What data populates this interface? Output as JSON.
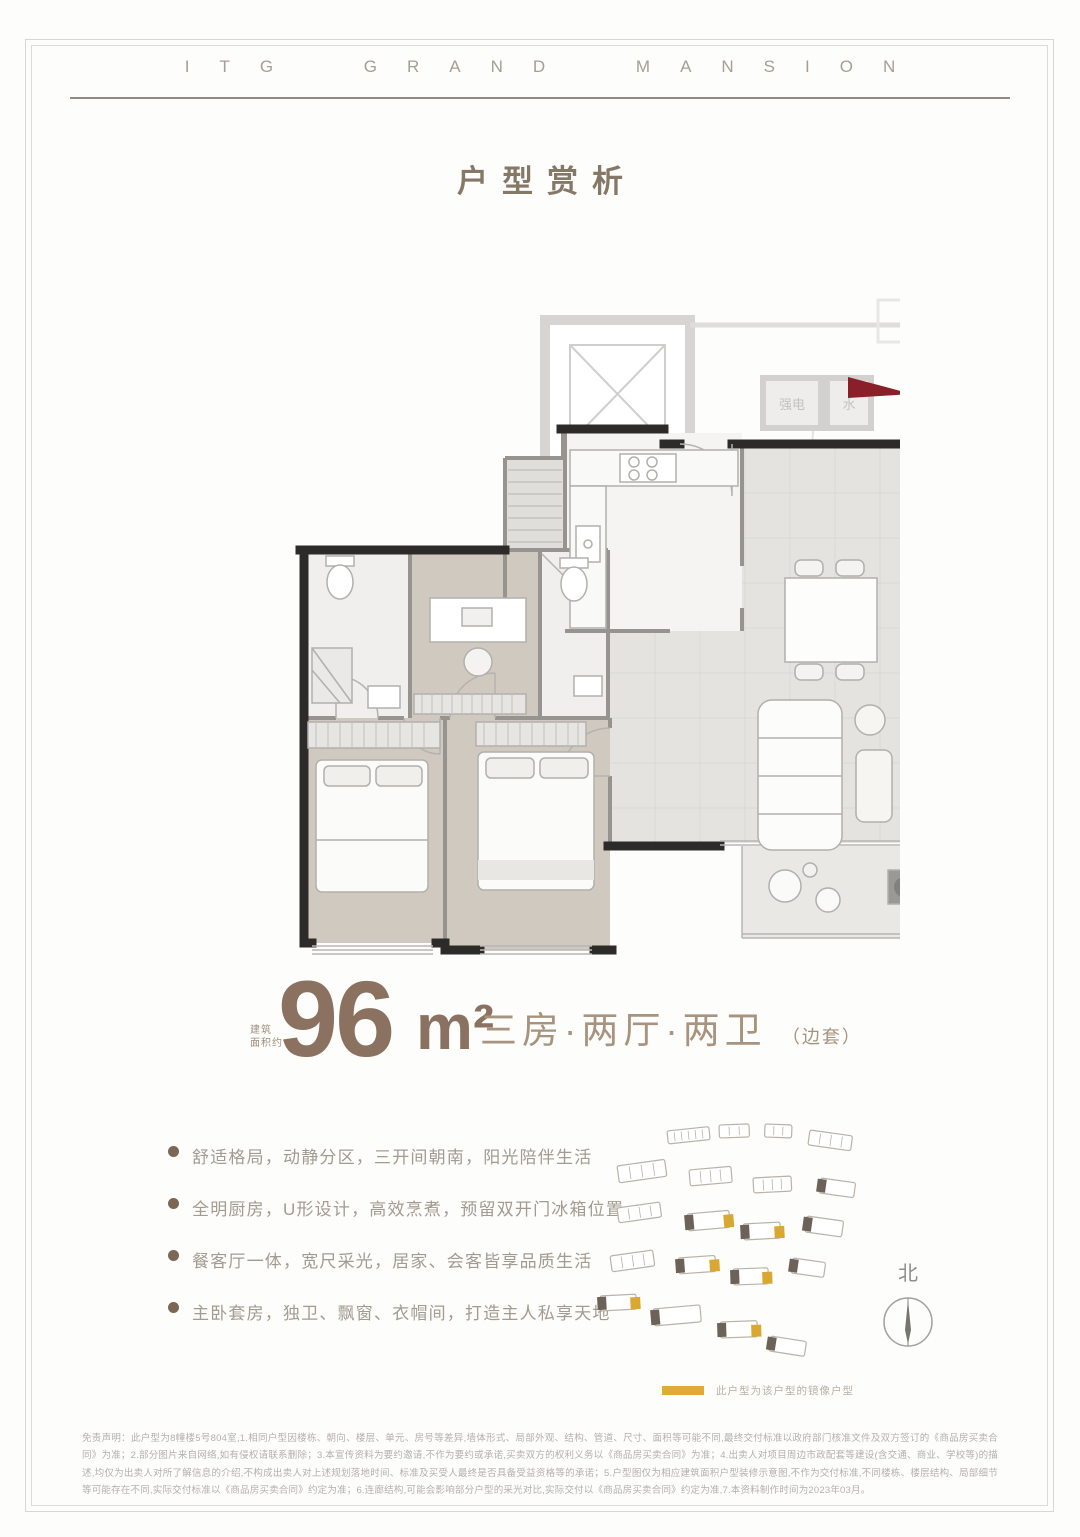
{
  "brand": {
    "title": "ITG GRAND MANSION"
  },
  "page": {
    "title": "户型赏析"
  },
  "plan": {
    "utility_box_1": "强电",
    "utility_box_2": "水"
  },
  "area": {
    "label_line1": "建筑",
    "label_line2": "面积约",
    "value": "96",
    "unit": "m²"
  },
  "spec": {
    "rooms": "三房·两厅·两卫",
    "note": "（边套）"
  },
  "features": [
    "舒适格局，动静分区，三开间朝南，阳光陪伴生活",
    "全明厨房，U形设计，高效烹煮，预留双开门冰箱位置",
    "餐客厅一体，宽尺采光，居家、会客皆享品质生活",
    "主卧套房，独卫、飘窗、衣帽间，打造主人私享天地"
  ],
  "site": {
    "north": "北",
    "legend": "此户型为该户型的镜像户型"
  },
  "disclaimer": "免责声明：此户型为8幢楼5号804室,1.相同户型因楼栋、朝向、楼层、单元、房号等差异,墙体形式、局部外观、结构、管道、尺寸、面积等可能不同,最终交付标准以政府部门核准文件及双方签订的《商品房买卖合同》为准；2.部分图片来自网络,如有侵权请联系删除；3.本宣传资料为要约邀请,不作为要约或承诺,买卖双方的权利义务以《商品房买卖合同》为准；4.出卖人对项目周边市政配套等建设(含交通、商业、学校等)的描述,均仅为出卖人对所了解信息的介绍,不构成出卖人对上述规划落地时间、标准及买受人最终是否具备受益资格等的承诺；5.户型图仅为相应建筑面积户型装修示意图,不作为交付标准,不同楼栋、楼层结构、局部细节等可能存在不同,实际交付标准以《商品房买卖合同》约定为准；6.连廊结构,可能会影响部分户型的采光对比,实际交付以《商品房买卖合同》约定为准,7.本资料制作时间为2023年03月。",
  "colors": {
    "brand_brown": "#8b7260",
    "text_brown": "#a8937e",
    "legend_gold": "#e0ab35",
    "entry_red": "#8a1f2a",
    "wall_black": "#2c2b29"
  }
}
